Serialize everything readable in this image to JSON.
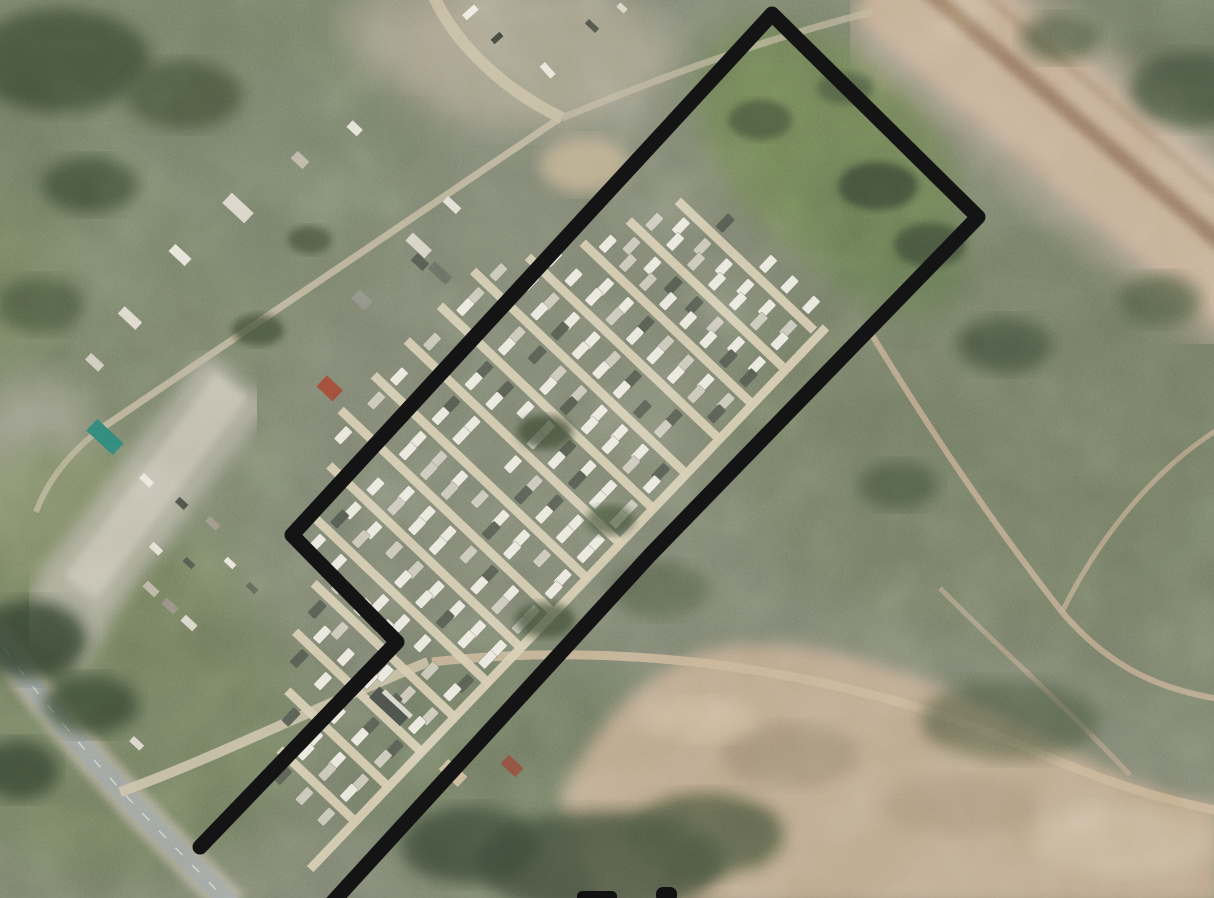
{
  "image": {
    "kind": "satellite-aerial-photograph",
    "subject": "Aerial view of a mobile-home/trailer park parcel outlined with a thick black property boundary, surrounded by scrubland, a dirt rail corridor at top right, a bare dirt field at bottom right and a highway at bottom left",
    "width_px": 1214,
    "height_px": 898
  },
  "annotation": {
    "boundary": {
      "color": "#141414",
      "stroke_width": 15,
      "points": [
        [
          200,
          847
        ],
        [
          397,
          642
        ],
        [
          292,
          535
        ],
        [
          772,
          14
        ],
        [
          978,
          217
        ],
        [
          650,
          555
        ],
        [
          330,
          905
        ]
      ]
    },
    "cropped_caption_fragments": [
      {
        "x": 577,
        "y": 891,
        "width": 40,
        "height": 12,
        "rx": 5
      },
      {
        "x": 656,
        "y": 887,
        "width": 21,
        "height": 16,
        "rx": 7
      }
    ]
  },
  "terrain_palette": {
    "scrub_base": "#7d8370",
    "field_green": "#6e8152",
    "dirt_field": "#bfa88c",
    "rail_corridor": "#c6af94",
    "rail_track": "#94765f",
    "park_road": "#d4caae",
    "highway": "#9ba19c",
    "trailer_white": "#eae8dd",
    "tree_dark": "#3e4a35"
  },
  "trailer_park": {
    "origin": [
      652,
      170
    ],
    "rotation_deg": 43.6,
    "road_color": "#d4caae",
    "road_width": 9,
    "trailer": {
      "width": 9.5,
      "length": 18,
      "color": "#eae8dd",
      "alt_color": "#c9c6b8",
      "dark_color": "#565b50"
    },
    "long_roads": [
      {
        "x": 230,
        "y0": -6,
        "y1": 742
      }
    ],
    "strips": [
      {
        "y": 0,
        "x0": 40,
        "x1": 228,
        "trailers": 6
      },
      {
        "y": 48,
        "x0": 18,
        "x1": 230,
        "trailers": 7
      },
      {
        "y": 96,
        "x0": 0,
        "x1": 232,
        "trailers": 8
      },
      {
        "y": 144,
        "x0": -30,
        "x1": 234,
        "trailers": 9
      },
      {
        "y": 192,
        "x0": -60,
        "x1": 234,
        "trailers": 10
      },
      {
        "y": 240,
        "x0": -60,
        "x1": 236,
        "trailers": 10
      },
      {
        "y": 288,
        "x0": -60,
        "x1": 236,
        "trailers": 10
      },
      {
        "y": 336,
        "x0": -60,
        "x1": 236,
        "trailers": 10
      },
      {
        "y": 384,
        "x0": -60,
        "x1": 238,
        "trailers": 10
      },
      {
        "y": 432,
        "x0": -30,
        "x1": 238,
        "trailers": 9
      },
      {
        "y": 480,
        "x0": -5,
        "x1": 238,
        "trailers": 8
      },
      {
        "y": 528,
        "x0": 40,
        "x1": 236,
        "trailers": 6
      },
      {
        "y": 576,
        "x0": 60,
        "x1": 234,
        "trailers": 5
      },
      {
        "y": 624,
        "x0": 95,
        "x1": 232,
        "trailers": 4
      },
      {
        "y": 672,
        "x0": 130,
        "x1": 230,
        "trailers": 3
      }
    ]
  }
}
